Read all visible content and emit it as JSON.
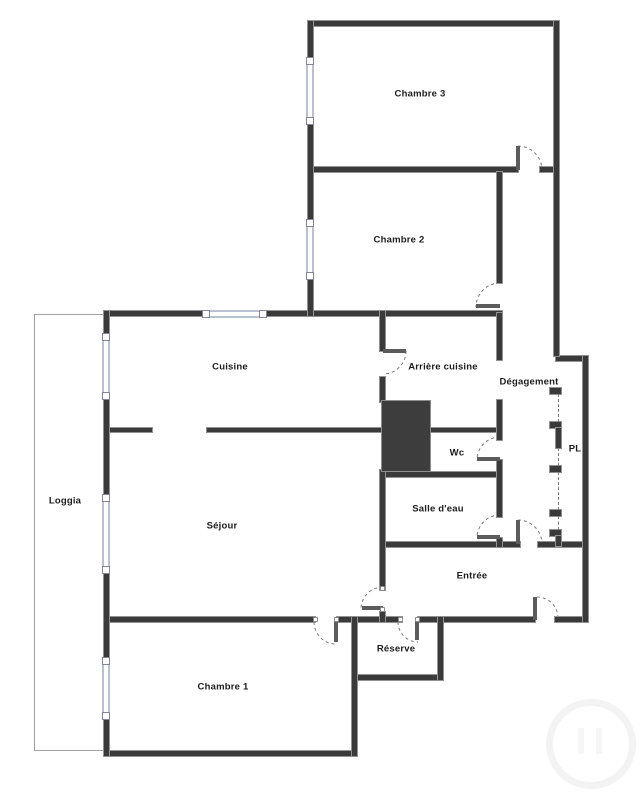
{
  "plan": {
    "type": "apartment-floor-plan",
    "rooms": {
      "chambre3": {
        "label": "Chambre 3"
      },
      "chambre2": {
        "label": "Chambre 2"
      },
      "cuisine": {
        "label": "Cuisine"
      },
      "arriere_cuisine": {
        "label": "Arrière cuisine"
      },
      "degagement": {
        "label": "Dégagement"
      },
      "pl": {
        "label": "PL"
      },
      "wc": {
        "label": "Wc"
      },
      "salle_deau": {
        "label": "Salle d'eau"
      },
      "loggia": {
        "label": "Loggia"
      },
      "sejour": {
        "label": "Séjour"
      },
      "entree": {
        "label": "Entrée"
      },
      "reserve": {
        "label": "Réserve"
      },
      "chambre1": {
        "label": "Chambre 1"
      }
    },
    "theme": {
      "wall": "#3a3a3a",
      "wall-edge": "#929292",
      "window": "#b9c0d2",
      "shaft": "#3d3d3d",
      "arc": "#7a7a7a",
      "label": "#1c1c1c",
      "bg": "#ffffff",
      "wm": "#f3f3f3"
    }
  }
}
